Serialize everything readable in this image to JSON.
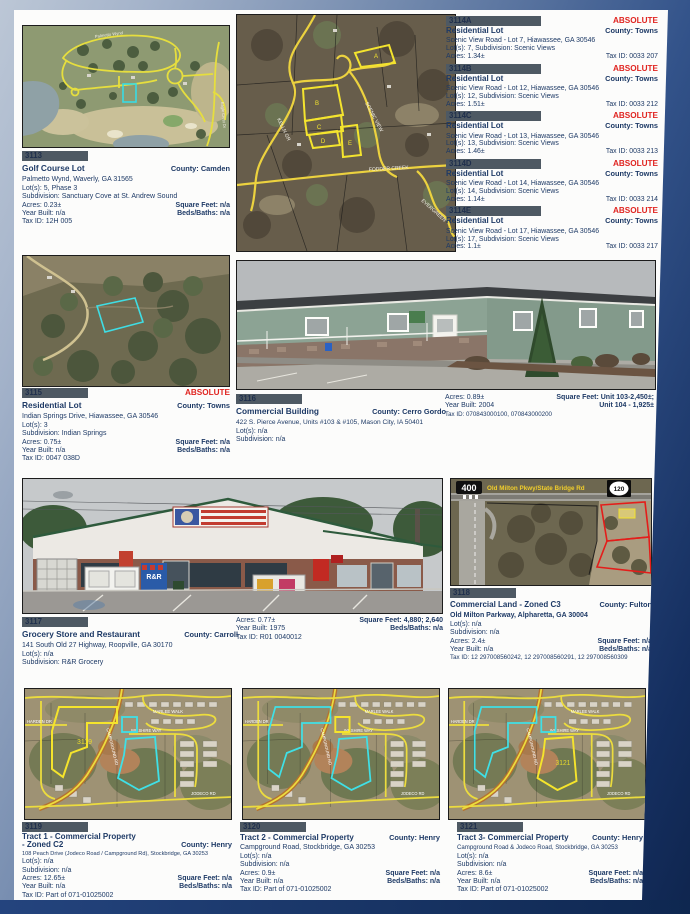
{
  "labels": {
    "county": "County:",
    "absolute": "ABSOLUTE"
  },
  "colors": {
    "accent_red": "#E02420",
    "text_navy": "#1E3A66",
    "idbar_bg": "#4E5963",
    "page_bg": "#FCFCFB"
  },
  "listings": {
    "p3113": {
      "id": "3113",
      "title": "Golf Course Lot",
      "county": "Camden",
      "address": "Palmetto Wynd, Waverly, GA  31565",
      "lots": "Lot(s): 5, Phase 3",
      "subdivision": "Subdivision: Sanctuary Cove at St. Andrew Sound",
      "acres": "Acres: 0.23±",
      "year": "Year Built: n/a",
      "tax": "Tax ID: 12H 005",
      "sqft": "Square Feet: n/a",
      "beds": "Beds/Baths: n/a"
    },
    "p3115": {
      "id": "3115",
      "title": "Residential Lot",
      "county": "Towns",
      "address": "Indian Springs Drive, Hiawassee, GA  30546",
      "lots": "Lot(s): 3",
      "subdivision": "Subdivision: Indian Springs",
      "acres": "Acres: 0.75±",
      "year": "Year Built: n/a",
      "tax": "Tax ID: 0047 038D",
      "sqft": "Square Feet: n/a",
      "beds": "Beds/Baths: n/a"
    },
    "p3116": {
      "id": "3116",
      "title": "Commercial Building",
      "county": "Cerro Gordo",
      "address": "422 S. Pierce Avenue, Units #103 & #105, Mason City, IA  50401",
      "lots": "Lot(s): n/a",
      "subdivision": "Subdivision: n/a",
      "acres": "Acres: 0.89±",
      "year": "Year Built: 2004",
      "tax": "Tax ID: 070843000100, 070843000200",
      "sqft1": "Square Feet: Unit 103-2,450±;",
      "sqft2": "Unit 104 - 1,925±"
    },
    "p3117": {
      "id": "3117",
      "title": "Grocery Store and Restaurant",
      "county": "Carroll",
      "address": "141 South Old 27 Highway, Roopville, GA  30170",
      "lots": "Lot(s): n/a",
      "subdivision": "Subdivision: R&R Grocery",
      "acres": "Acres: 0.77±",
      "year": "Year Built: 1975",
      "tax": "Tax ID: R01 0040012",
      "sqft": "Square Feet: 4,880; 2,640",
      "beds": "Beds/Baths: n/a"
    },
    "p3118": {
      "id": "3118",
      "title": "Commercial Land - Zoned C3",
      "county": "Fulton",
      "address": "Old Milton Parkway, Alpharetta, GA  30004",
      "lots": "Lot(s): n/a",
      "subdivision": "Subdivision: n/a",
      "acres": "Acres: 2.4±",
      "year": "Year Built: n/a",
      "tax": "Tax ID: 12 297008560242, 12 297008560291, 12 297008560309",
      "sqft": "Square Feet: n/a",
      "beds": "Beds/Baths: n/a"
    },
    "p3119": {
      "id": "3119",
      "title1": "Tract 1 - Commercial Property",
      "title2": "- Zoned C2",
      "county": "Henry",
      "address": "108 Peach Drive (Jodeco Road / Campground Rd), Stockbridge, GA  30253",
      "lots": "Lot(s): n/a",
      "subdivision": "Subdivision: n/a",
      "acres": "Acres: 12.65±",
      "year": "Year Built: n/a",
      "tax": "Tax ID: Part of 071-01025002",
      "sqft": "Square Feet: n/a",
      "beds": "Beds/Baths: n/a"
    },
    "p3120": {
      "id": "3120",
      "title1": "Tract 2 - Commercial Property",
      "county": "Henry",
      "address": "Campground Road, Stockbridge, GA  30253",
      "lots": "Lot(s): n/a",
      "subdivision": "Subdivision: n/a",
      "acres": "Acres: 0.9±",
      "year": "Year Built: n/a",
      "tax": "Tax ID: Part of 071-01025002",
      "sqft": "Square Feet: n/a",
      "beds": "Beds/Baths: n/a"
    },
    "p3121": {
      "id": "3121",
      "title1": "Tract 3- Commercial Property",
      "county": "Henry",
      "address": "Campground Road & Jodeco Road, Stockbridge, GA  30253",
      "lots": "Lot(s): n/a",
      "subdivision": "Subdivision: n/a",
      "acres": "Acres: 8.6±",
      "year": "Year Built: n/a",
      "tax": "Tax ID: Part of 071-01025002",
      "sqft": "Square Feet: n/a",
      "beds": "Beds/Baths: n/a"
    }
  },
  "scenic_lots": [
    {
      "id": "3114A",
      "absolute": "ABSOLUTE",
      "type": "Residential Lot",
      "county": "Towns",
      "address": "Scenic View Road -  Lot 7, Hiawassee, GA  30546",
      "line2": "Lot(s): 7, Subdivision: Scenic Views",
      "acres": "Acres: 1.34±",
      "tax": "Tax ID: 0033 207"
    },
    {
      "id": "3114B",
      "absolute": "ABSOLUTE",
      "type": "Residential Lot",
      "county": "Towns",
      "address": "Scenic View Road - Lot 12, Hiawassee, GA  30546",
      "line2": "Lot(s): 12, Subdivision: Scenic Views",
      "acres": "Acres: 1.51±",
      "tax": "Tax ID: 0033 212"
    },
    {
      "id": "3114C",
      "absolute": "ABSOLUTE",
      "type": "Residential Lot",
      "county": "Towns",
      "address": "Scenic View Road - Lot 13, Hiawassee, GA  30546",
      "line2": "Lot(s): 13, Subdivision: Scenic Views",
      "acres": "Acres: 1.46±",
      "tax": "Tax ID: 0033 213"
    },
    {
      "id": "3114D",
      "absolute": "ABSOLUTE",
      "type": "Residential Lot",
      "county": "Towns",
      "address": "Scenic View Road - Lot 14, Hiawassee, GA  30546",
      "line2": "Lot(s): 14, Subdivision: Scenic Views",
      "acres": "Acres: 1.14±",
      "tax": "Tax ID: 0033 214"
    },
    {
      "id": "3114E",
      "absolute": "ABSOLUTE",
      "type": "Residential Lot",
      "county": "Towns",
      "address": "Scenic View Road - Lot 17, Hiawassee, GA  30546",
      "line2": "Lot(s): 17, Subdivision: Scenic Views",
      "acres": "Acres: 1.1±",
      "tax": "Tax ID: 0033 217"
    }
  ],
  "maps": {
    "golf": {
      "road1": "Palmetto Wynd",
      "road2": "Eagle Crest Dr"
    },
    "scenic": {
      "pa": "A",
      "pb": "B",
      "pc": "C",
      "pd": "D",
      "pe": "E",
      "road1": "KELLN GR",
      "road2": "SCENIC VIEW",
      "road3": "FODDER CREEK",
      "road4": "EVERGREEN"
    },
    "milton": {
      "shield_400": "400",
      "road": "Old Milton Pkwy/State Bridge Rd",
      "shield_120": "120"
    },
    "suburb": {
      "road_harden": "HARDEN DR",
      "road_marlee": "MARLEE WALK",
      "road_wilshire": "WILSHIRE WAY",
      "road_jodeco": "JODECO RD",
      "road_campground": "CAMPGROUND RD",
      "tag1": "3119",
      "tag3": "3121"
    },
    "store": {
      "ice": "ICE",
      "rr": "R&R"
    }
  }
}
